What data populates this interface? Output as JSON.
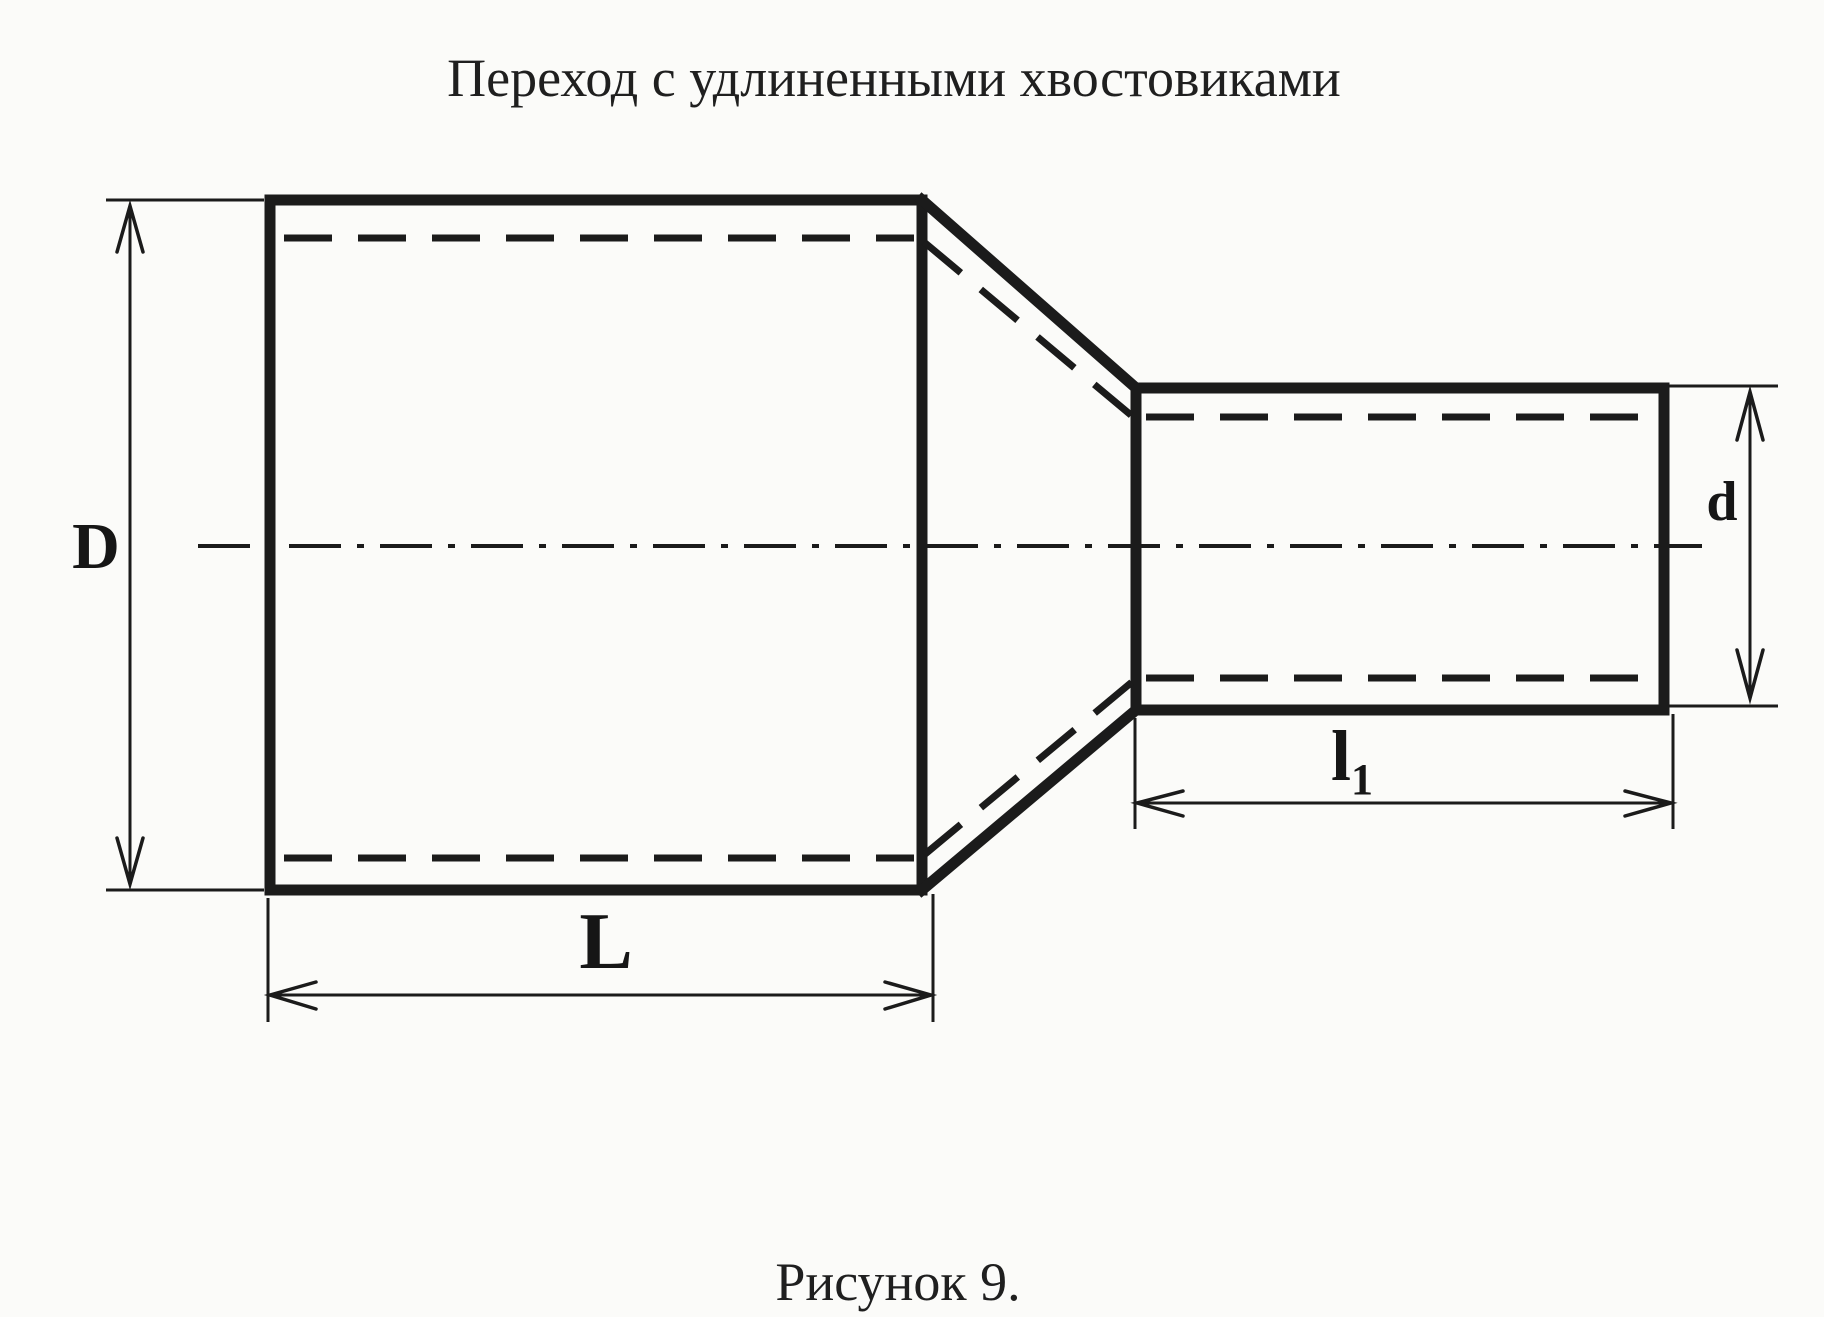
{
  "page": {
    "title": "Переход с удлиненными хвостовиками",
    "caption": "Рисунок 9."
  },
  "diagram": {
    "type": "technical-drawing",
    "subject": "concentric pipe reducer with elongated tailpieces, side view with hidden inner walls and center axis",
    "colors": {
      "ink": "#1b1b1b",
      "paper": "#fbfbf9"
    },
    "dimensions": {
      "big_diameter_label": "D",
      "small_diameter_label": "d",
      "big_length_label": "L",
      "small_length_label_main": "l",
      "small_length_label_sub": "1"
    }
  }
}
